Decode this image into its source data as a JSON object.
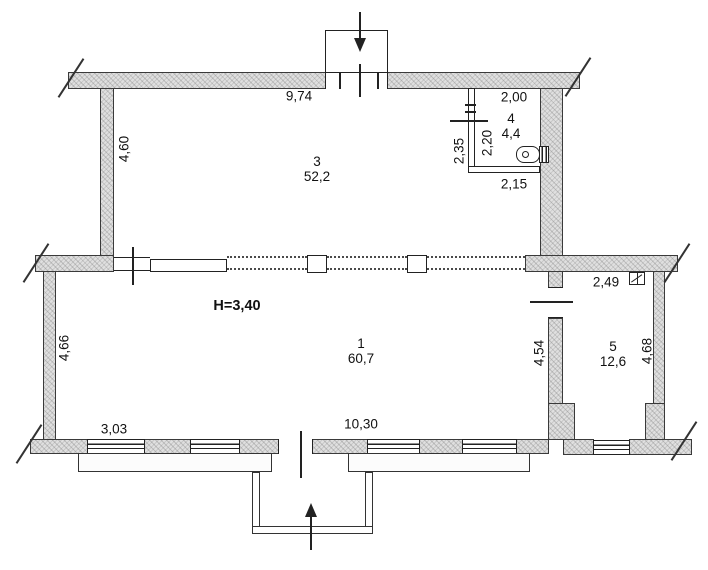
{
  "plan": {
    "height_note": "H=3,40",
    "rooms": {
      "r1": {
        "number": "1",
        "area": "60,7"
      },
      "r3": {
        "number": "3",
        "area": "52,2"
      },
      "r4": {
        "number": "4",
        "area": "4,4"
      },
      "r5": {
        "number": "5",
        "area": "12,6"
      }
    },
    "dimensions": {
      "top_width": "9,74",
      "room3_height": "4,60",
      "room4_width_top": "2,00",
      "room4_height_inner": "2,20",
      "room4_height_left": "2,35",
      "room4_width_bottom": "2,15",
      "room5_width_top": "2,49",
      "room1_right_height": "4,54",
      "room5_height_right": "4,68",
      "room1_left_height": "4,66",
      "bottom_left_width": "3,03",
      "bottom_main_width": "10,30"
    },
    "icons": {
      "room4_fixture": "boiler-icon",
      "room5_fixture": "vent-grille-icon",
      "top_entrance": "arrow-down-icon",
      "bottom_entrance": "arrow-up-icon"
    }
  }
}
